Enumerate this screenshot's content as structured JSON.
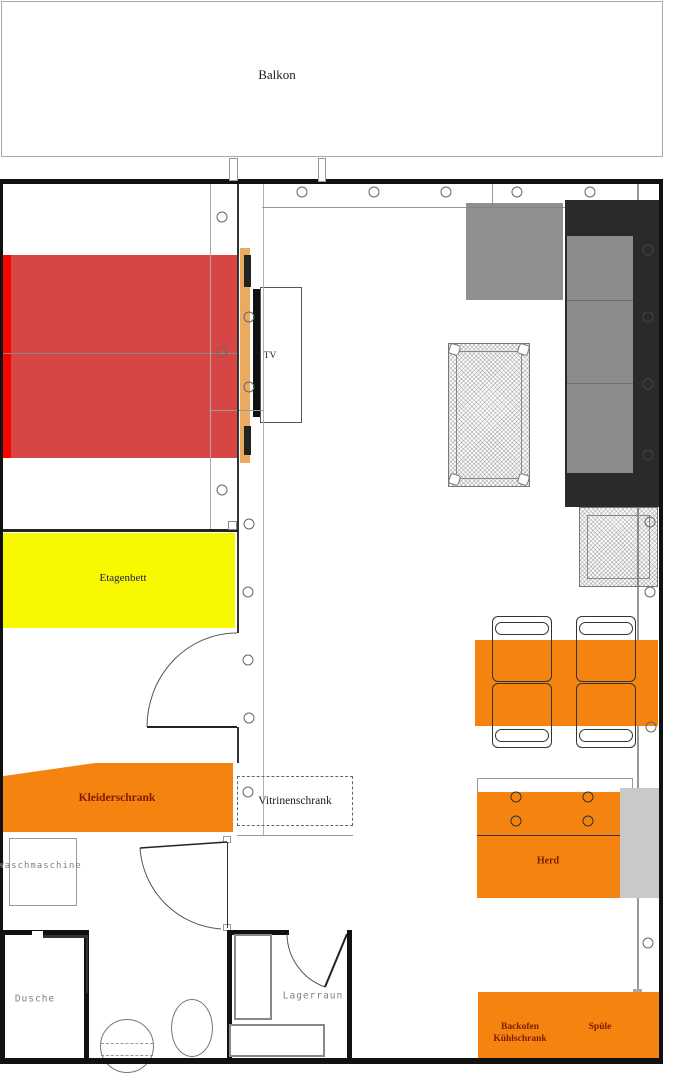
{
  "labels": {
    "balcony": "Balkon",
    "tv": "TV",
    "bunk_bed": "Etagenbett",
    "wardrobe": "Kleiderschrank",
    "display_cabinet": "Vitrinenschrank",
    "washing_machine": "Waschmaschine",
    "shower": "Dusche",
    "storage_room": "Lagerraun",
    "stove": "Herd",
    "oven": "Backofen",
    "fridge": "Kühlschrank",
    "sink": "Spüle"
  },
  "colors": {
    "bed_red": "#d84545",
    "bed_red_bright": "#f50400",
    "bunk_bed_yellow": "#f8f800",
    "furniture_orange": "#f5830f",
    "label_maroon": "#7b1d00",
    "label_navy": "#1c1c4e",
    "sofa_gray": "#8c8c8c",
    "sofa_black": "#2a2a2a",
    "tv_board_tan": "#eaab61",
    "appliance_gray": "#c9c9c9",
    "wall_black": "#111111"
  },
  "dots": {
    "top_wall": [
      [
        302,
        192
      ],
      [
        374,
        192
      ],
      [
        446,
        192
      ],
      [
        517,
        192
      ],
      [
        590,
        192
      ]
    ],
    "left_strip": [
      [
        222,
        217
      ],
      [
        222,
        352
      ],
      [
        222,
        490
      ]
    ],
    "mid_strip": [
      [
        249,
        317
      ],
      [
        249,
        387
      ],
      [
        249,
        524
      ],
      [
        248,
        592
      ],
      [
        248,
        660
      ],
      [
        249,
        718
      ]
    ],
    "cabinet": [
      [
        248,
        792
      ]
    ],
    "right_wall_light": [
      [
        650,
        522
      ],
      [
        650,
        592
      ],
      [
        651,
        727
      ],
      [
        648,
        943
      ]
    ],
    "right_wall_dark": [
      [
        648,
        250
      ],
      [
        648,
        317
      ],
      [
        648,
        384
      ],
      [
        648,
        455
      ]
    ],
    "burners": [
      [
        516,
        797
      ],
      [
        588,
        797
      ],
      [
        516,
        821
      ],
      [
        588,
        821
      ]
    ]
  }
}
